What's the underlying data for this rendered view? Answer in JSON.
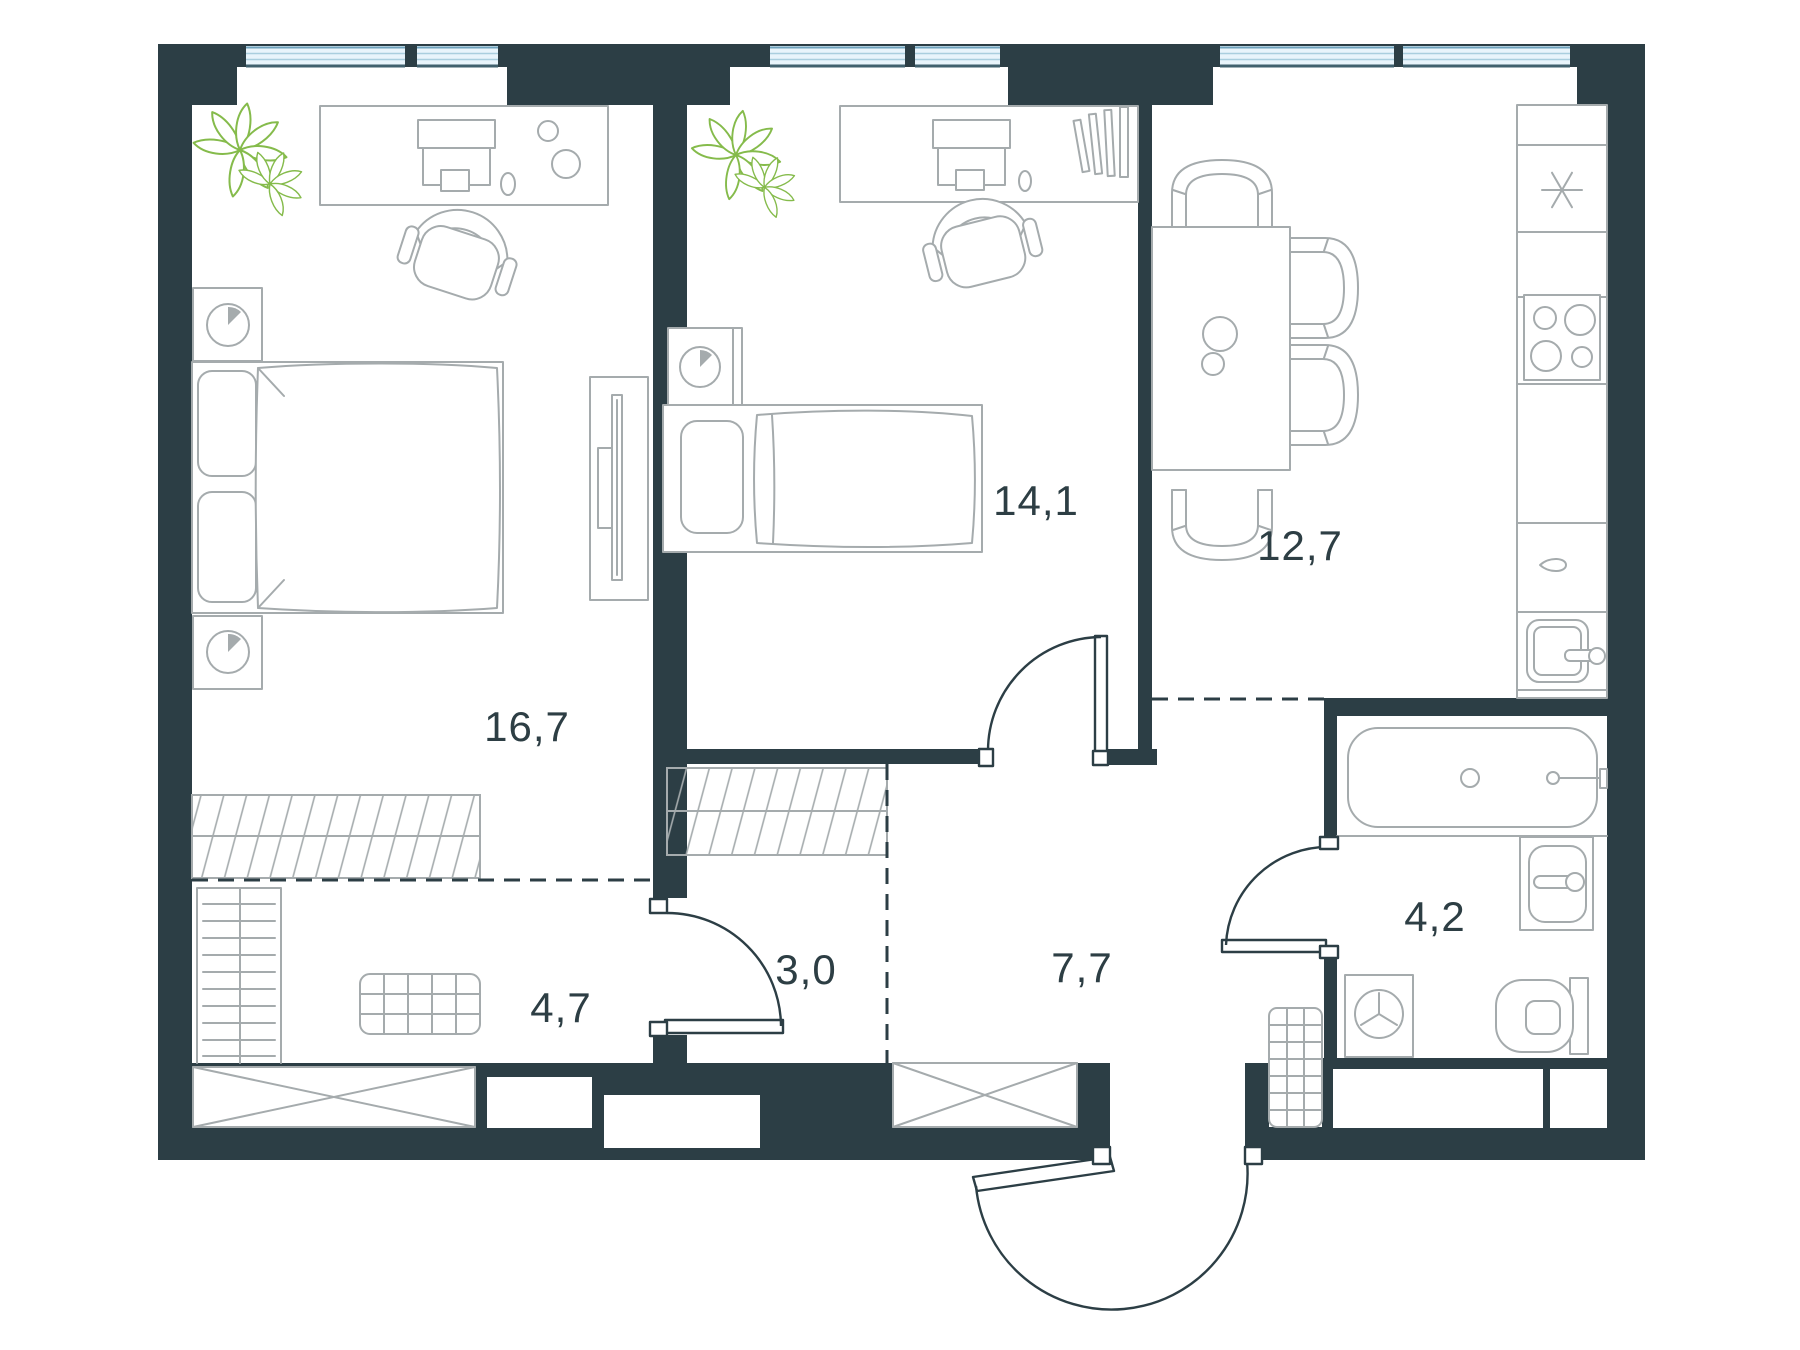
{
  "plan": {
    "type": "apartment-floor-plan",
    "rooms": [
      {
        "key": "bedroom-large",
        "area_label": "16,7"
      },
      {
        "key": "bedroom-small",
        "area_label": "14,1"
      },
      {
        "key": "kitchen-living",
        "area_label": "12,7"
      },
      {
        "key": "wardrobe-zone",
        "area_label": "4,7"
      },
      {
        "key": "corridor",
        "area_label": "3,0"
      },
      {
        "key": "hallway",
        "area_label": "7,7"
      },
      {
        "key": "bathroom",
        "area_label": "4,2"
      }
    ]
  },
  "colors": {
    "wall": "#2c3e45",
    "furniture_outline": "#a5abad",
    "window_fill": "#e8f4fb",
    "window_frame": "#6fa3bd",
    "window_mid": "#a9cede",
    "window_sill": "#41616e",
    "plant": "#85bb4b",
    "label_text": "#2d3e44"
  }
}
